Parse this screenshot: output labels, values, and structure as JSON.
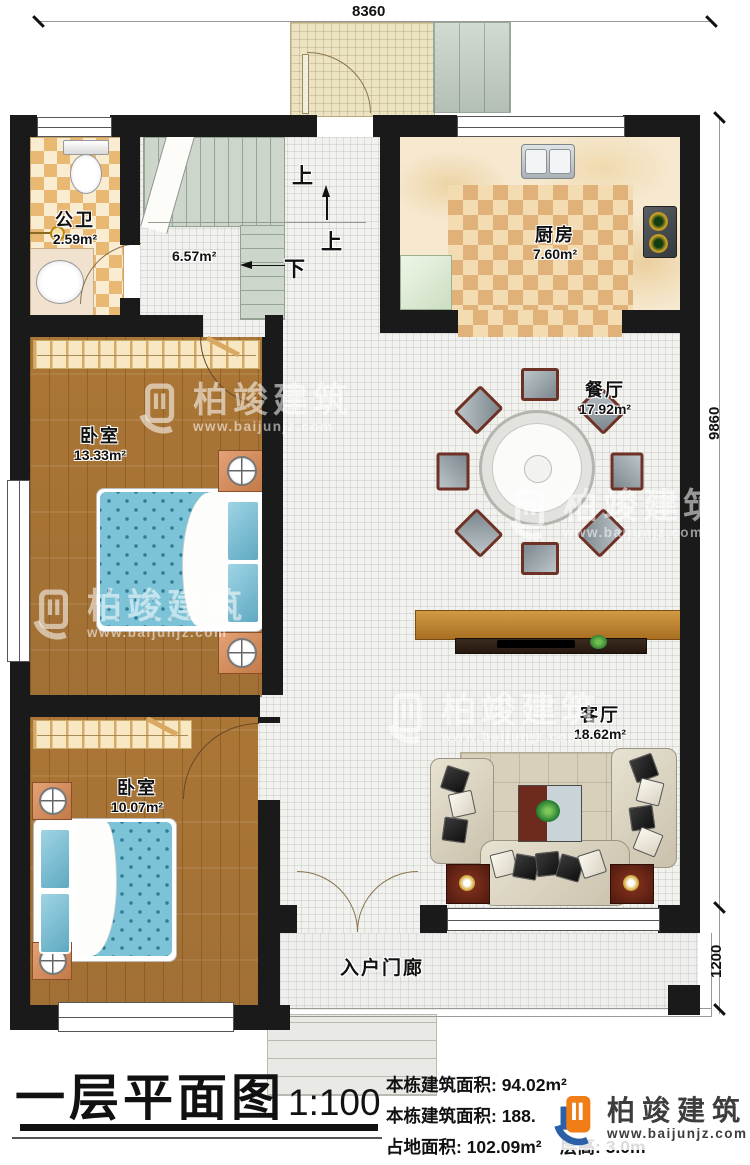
{
  "dimensions": {
    "top_width": "8360",
    "side_height": "9860",
    "porch_depth": "1200"
  },
  "rooms": {
    "bathroom": {
      "name": "公卫",
      "area": "2.59m²"
    },
    "stair_hall": {
      "area": "6.57m²"
    },
    "kitchen": {
      "name": "厨房",
      "area": "7.60m²"
    },
    "dining": {
      "name": "餐厅",
      "area": "17.92m²"
    },
    "bedroom1": {
      "name": "卧室",
      "area": "13.33m²"
    },
    "bedroom2": {
      "name": "卧室",
      "area": "10.07m²"
    },
    "living": {
      "name": "客厅",
      "area": "18.62m²"
    },
    "porch": {
      "name": "入户门廊"
    }
  },
  "stairs": {
    "up_label": "上",
    "up_label_2": "上",
    "down_label": "下"
  },
  "title_block": {
    "title": "一层平面图",
    "scale": "1:100",
    "info_line1": "本栋建筑面积: 94.02m²",
    "info_line2": "本栋建筑面积: 188.",
    "info_line3": "占地面积: 102.09m²",
    "info_line4": "层高: 3.0m"
  },
  "brand": {
    "name": "柏竣建筑",
    "url": "www.baijunjz.com"
  },
  "watermark": {
    "name": "柏竣建筑",
    "url": "www.baijunjz.com"
  },
  "colors": {
    "wall": "#1a1a1a",
    "logo_orange": "#f07d16",
    "logo_blue": "#2b5fa7",
    "bed": "#7cc3d8",
    "wood_floor": "#b5813f"
  }
}
